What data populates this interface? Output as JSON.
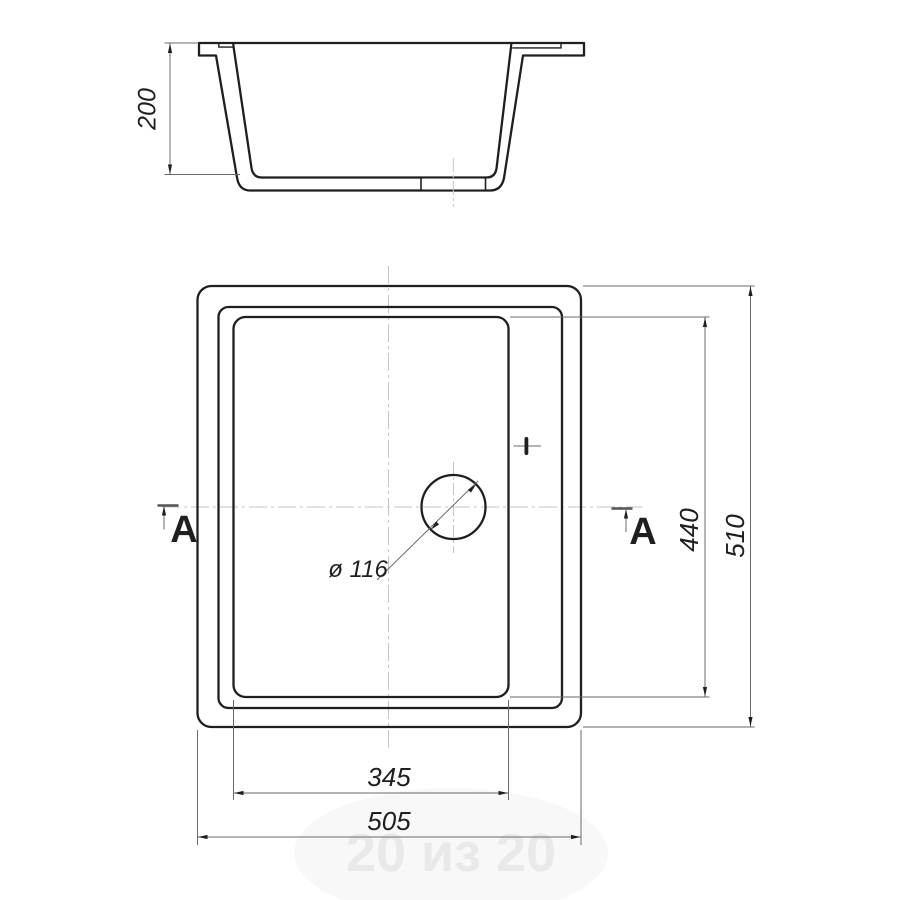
{
  "drawing": {
    "kind": "sink-technical-drawing",
    "section_cut": {
      "label": "A"
    },
    "dimensions": {
      "depth": "200",
      "bowl_width": "345",
      "overall_width": "505",
      "bowl_length": "440",
      "overall_length": "510",
      "drain_diameter": "ø 116"
    },
    "watermark": "20 из 20",
    "colors": {
      "line": "#1f1f1f",
      "dim_line": "#6a6a6a",
      "centerline": "#c6c6c6",
      "watermark_text": "#e9e9e9",
      "watermark_ellipse": "#f8f8f8",
      "background": "#ffffff"
    }
  }
}
